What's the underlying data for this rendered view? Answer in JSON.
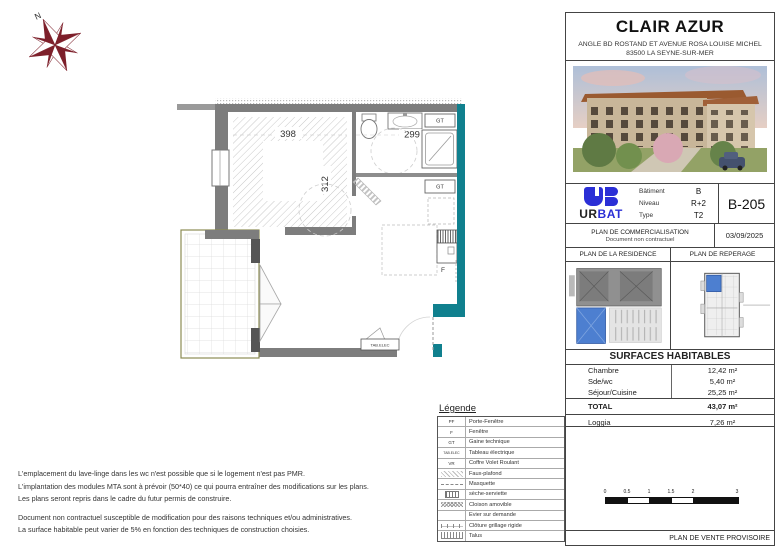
{
  "compass": {
    "north": "N"
  },
  "plan": {
    "dim_chambre_width": "398",
    "dim_chambre_height": "312",
    "dim_bath": "299",
    "gt1": "GT",
    "gt2": "GT",
    "tab_elec": "TAB.ELEC",
    "window_label": "F"
  },
  "title_block": {
    "title": "CLAIR AZUR",
    "address_line1": "ANGLE BD ROSTAND ET AVENUE ROSA LOUISE MICHEL",
    "address_line2": "83500 LA SEYNE-SUR-MER"
  },
  "info": {
    "logo_black": "UR",
    "logo_blue": "BAT",
    "rows": [
      {
        "label": "Bâtiment",
        "value": "B"
      },
      {
        "label": "Niveau",
        "value": "R+2"
      },
      {
        "label": "Type",
        "value": "T2"
      }
    ],
    "unit": "B-205",
    "plan_type": "PLAN DE COMMERCIALISATION",
    "plan_note": "Document non contractuel",
    "date": "03/09/2025"
  },
  "mini_plans": {
    "residence_title": "PLAN DE LA RESIDENCE",
    "reperage_title": "PLAN DE REPERAGE"
  },
  "surfaces": {
    "title": "SURFACES HABITABLES",
    "rows": [
      {
        "label": "Chambre",
        "value": "12,42 m²"
      },
      {
        "label": "Sde/wc",
        "value": "5,40 m²"
      },
      {
        "label": "Séjour/Cuisine",
        "value": "25,25 m²"
      }
    ],
    "total_label": "TOTAL",
    "total_value": "43,07 m²",
    "loggia_label": "Loggia",
    "loggia_value": "7,26 m²"
  },
  "scale": {
    "labels": [
      "0",
      "0.5",
      "1",
      "1.5",
      "2",
      "3"
    ]
  },
  "footer": {
    "text": "PLAN DE VENTE PROVISOIRE"
  },
  "legend": {
    "title": "Légende",
    "rows": [
      {
        "symbol": "PF",
        "label": "Porte-Fenêtre",
        "swatch": "none"
      },
      {
        "symbol": "F",
        "label": "Fenêtre",
        "swatch": "none"
      },
      {
        "symbol": "GT",
        "label": "Gaine technique",
        "swatch": "none"
      },
      {
        "symbol": "TAB.ELEC",
        "label": "Tableau électrique",
        "swatch": "none"
      },
      {
        "symbol": "VR",
        "label": "Coffre Volet Roulant",
        "swatch": "none"
      },
      {
        "symbol": "",
        "label": "Faux-plafond",
        "swatch": "hatch"
      },
      {
        "symbol": "",
        "label": "Masquette",
        "swatch": "masquette"
      },
      {
        "symbol": "",
        "label": "sèche-serviette",
        "swatch": "seche"
      },
      {
        "symbol": "",
        "label": "Cloison amovible",
        "swatch": "xhatch"
      },
      {
        "symbol": "",
        "label": "Evier sur demande",
        "swatch": "none"
      },
      {
        "symbol": "",
        "label": "Clôture grillage rigide",
        "swatch": "fence"
      },
      {
        "symbol": "",
        "label": "Talus",
        "swatch": "talus"
      }
    ]
  },
  "notes": {
    "lines": [
      "L'emplacement du lave-linge dans les wc n'est possible que si le logement n'est pas PMR.",
      "L'implantation des modules MTA sont à prévoir (50*40) ce qui pourra entraîner des modifications sur les plans.",
      "Les plans seront repris dans le cadre du futur permis de construire.",
      "Document non contractuel susceptible de modification pour des raisons techniques et/ou administratives.",
      "La surface habitable peut varier de 5% en fonction des techniques de construction choisies."
    ]
  },
  "colors": {
    "teal_wall": "#10808E",
    "urbat_blue": "#2B2FD6",
    "compass_red": "#7D1F2A",
    "highlight_blue": "#4D7FD0"
  }
}
